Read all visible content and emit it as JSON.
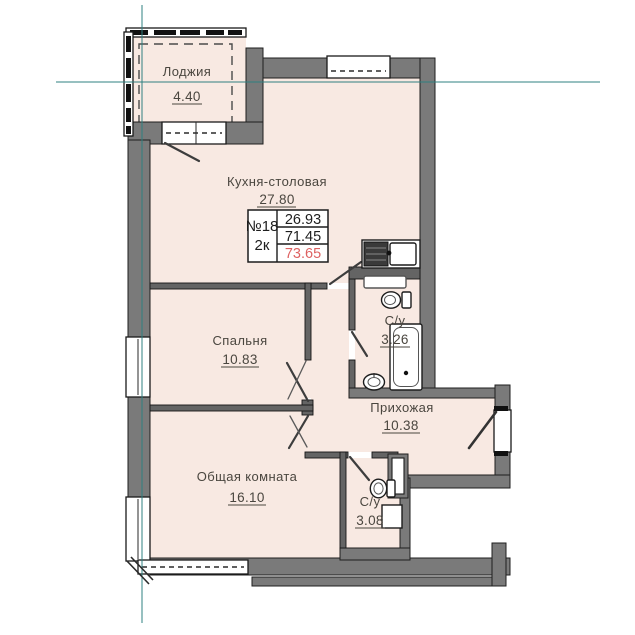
{
  "unit_card": {
    "number": "№18",
    "layout": "2к",
    "areas": {
      "living": "26.93",
      "total": "71.45",
      "total_with_loggia": "73.65"
    }
  },
  "rooms": {
    "loggia": {
      "name": "Лоджия",
      "area": "4.40"
    },
    "kitchen": {
      "name": "Кухня-столовая",
      "area": "27.80"
    },
    "bedroom": {
      "name": "Спальня",
      "area": "10.83"
    },
    "bathroom1": {
      "name": "С/у",
      "area": "3.26"
    },
    "hallway": {
      "name": "Прихожая",
      "area": "10.38"
    },
    "living": {
      "name": "Общая комната",
      "area": "16.10"
    },
    "bathroom2": {
      "name": "С/у",
      "area": "3.08"
    }
  },
  "colors": {
    "room_fill": "#f8e9e2",
    "wall": "#7a7a7a",
    "outline": "#1f1f1f",
    "axis_line": "#2f8080",
    "total_highlight": "#de6262",
    "label_text": "#4a463f"
  }
}
